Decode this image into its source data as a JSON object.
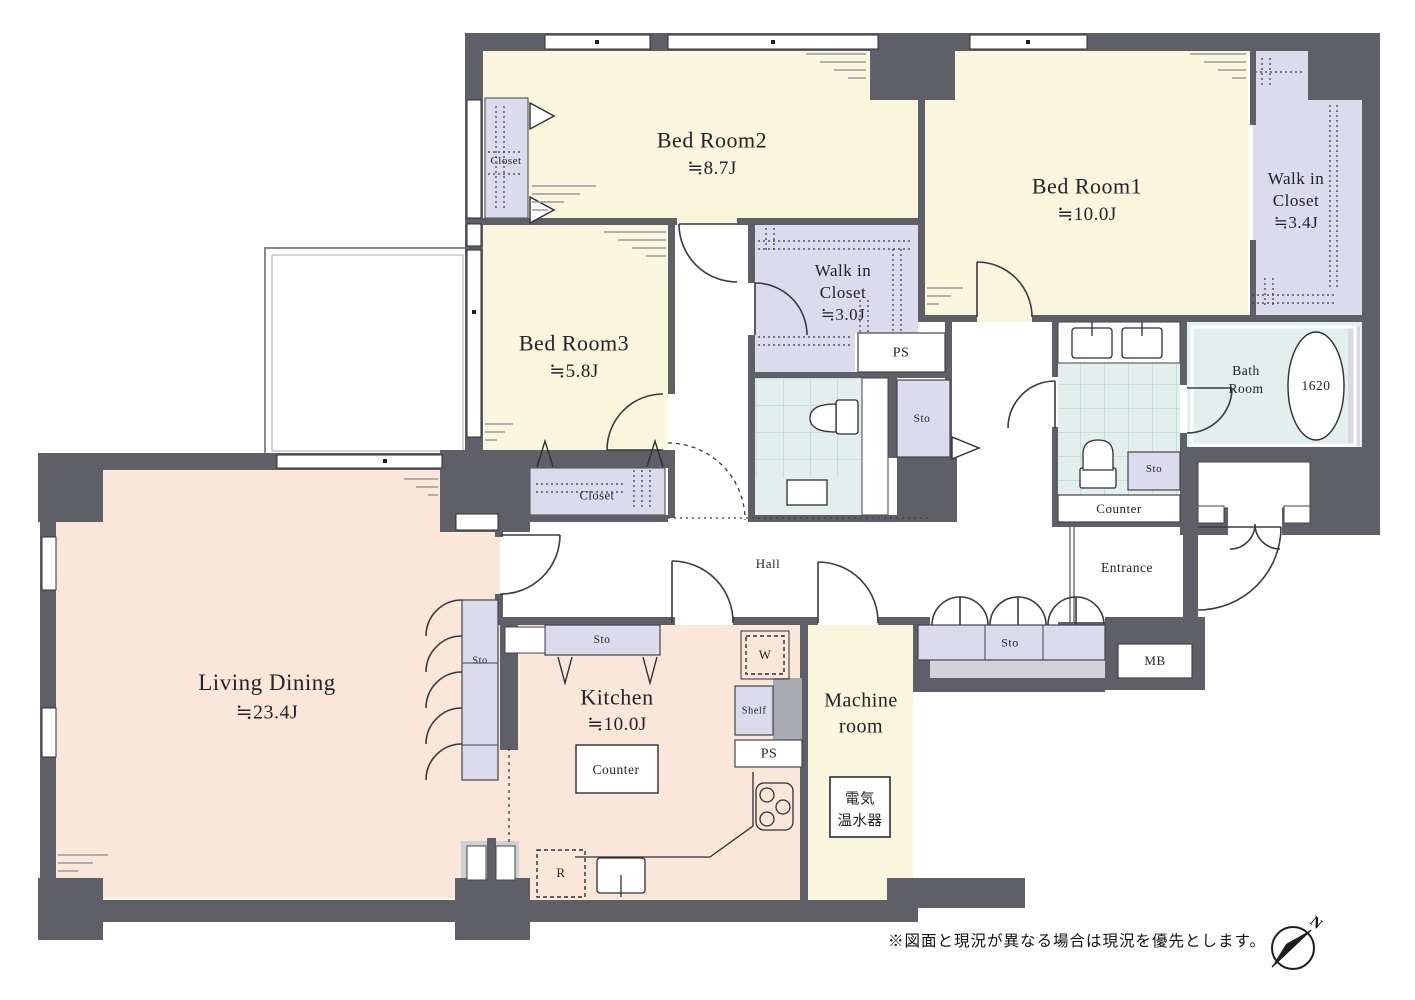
{
  "rooms": {
    "bedroom2": {
      "name": "Bed Room2",
      "size": "≒8.7J"
    },
    "bedroom1": {
      "name": "Bed Room1",
      "size": "≒10.0J"
    },
    "bedroom3": {
      "name": "Bed Room3",
      "size": "≒5.8J"
    },
    "walk_in_closet_1": {
      "line1": "Walk in",
      "line2": "Closet",
      "size": "≒3.4J"
    },
    "walk_in_closet_2": {
      "line1": "Walk in",
      "line2": "Closet",
      "size": "≒3.0J"
    },
    "living_dining": {
      "name": "Living Dining",
      "size": "≒23.4J"
    },
    "kitchen": {
      "name": "Kitchen",
      "size": "≒10.0J"
    },
    "machine_room": {
      "line1": "Machine",
      "line2": "room"
    },
    "bath_room": {
      "line1": "Bath",
      "line2": "Room",
      "tub_size": "1620"
    },
    "entrance": {
      "name": "Entrance"
    },
    "hall": {
      "name": "Hall"
    }
  },
  "labels": {
    "closet": "Closet",
    "counter": "Counter",
    "sto": "Sto",
    "ps": "PS",
    "mb": "MB",
    "washer": "W",
    "shelf": "Shelf",
    "refrigerator": "R",
    "water_heater_line1": "電気",
    "water_heater_line2": "温水器"
  },
  "footer": {
    "note": "※図面と現況が異なる場合は現況を優先とします。"
  },
  "compass": {
    "north": "N"
  },
  "colors": {
    "wall": "#5f5f68",
    "bedroom_fill": "#faf5dd",
    "closet_fill": "#dcdbee",
    "living_fill": "#fbe7da",
    "wet_fill": "#e2efec",
    "tile_line": "#b7d3cd"
  }
}
